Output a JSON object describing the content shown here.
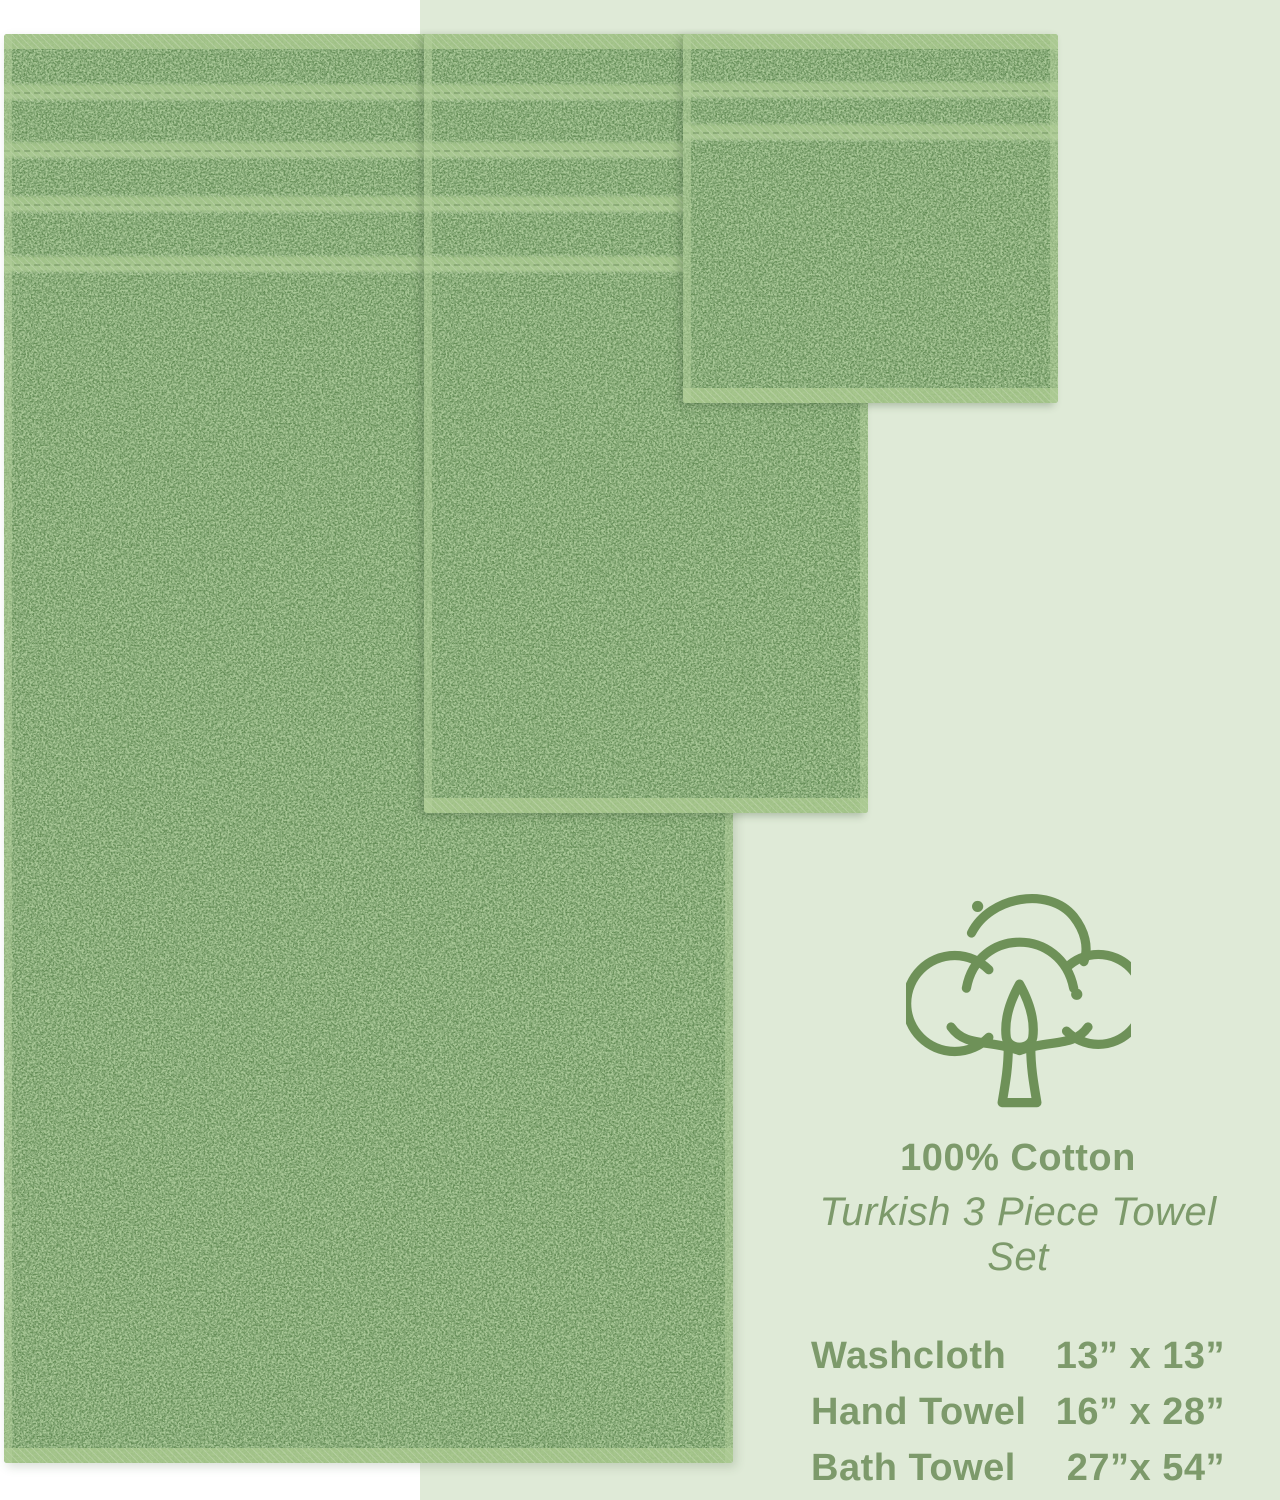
{
  "background": {
    "panel_color": "#dfead7",
    "page_color": "#ffffff"
  },
  "towels": {
    "base_color": "#82a674",
    "stripe_color": "#a6c68c",
    "items": [
      {
        "label": "bath-towel"
      },
      {
        "label": "hand-towel"
      },
      {
        "label": "washcloth"
      }
    ]
  },
  "product_info": {
    "icon": "cotton-flower-icon",
    "icon_color": "#6e9158",
    "text_color": "#7d9a6b",
    "cotton_label": "100% Cotton",
    "set_label": "Turkish 3 Piece Towel Set",
    "sizes": [
      {
        "item": "Washcloth",
        "dimensions": "13” x 13”"
      },
      {
        "item": "Hand Towel",
        "dimensions": "16” x 28”"
      },
      {
        "item": "Bath Towel",
        "dimensions": "27”x 54”"
      }
    ]
  }
}
